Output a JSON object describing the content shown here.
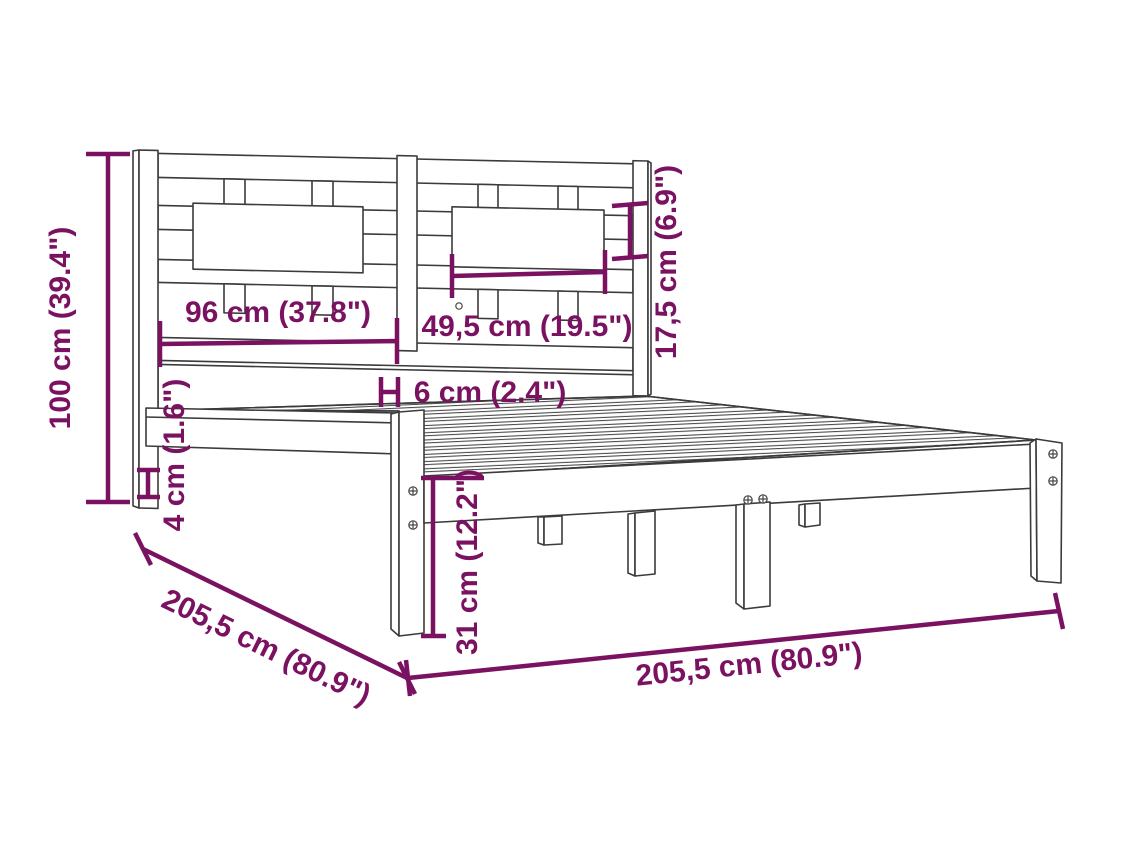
{
  "diagram": {
    "type": "furniture-dimension-diagram",
    "subject": "wooden slatted bed frame with headboard, 3/4 perspective line drawing",
    "accent_color": "#7A1261",
    "outline_color": "#3B3B3B",
    "background_color": "#FFFFFF",
    "dimensions": {
      "total_height": {
        "label": "100 cm (39.4\")",
        "cm": 100,
        "inches": 39.4,
        "measures": "headboard total height"
      },
      "headboard_section_width": {
        "label": "96 cm (37.8\")",
        "cm": 96,
        "inches": 37.8,
        "measures": "left headboard section width"
      },
      "panel_width": {
        "label": "49,5 cm (19.5\")",
        "cm": 49.5,
        "inches": 19.5,
        "measures": "headboard panel width"
      },
      "panel_height": {
        "label": "17,5 cm (6.9\")",
        "cm": 17.5,
        "inches": 6.9,
        "measures": "headboard panel height"
      },
      "slat_width": {
        "label": "6 cm (2.4\")",
        "cm": 6,
        "inches": 2.4,
        "measures": "divider slat width"
      },
      "rail_lip": {
        "label": "4 cm (1.6\")",
        "cm": 4,
        "inches": 1.6,
        "measures": "side rail lip height"
      },
      "base_height": {
        "label": "31 cm (12.2\")",
        "cm": 31,
        "inches": 12.2,
        "measures": "frame height to top of rail"
      },
      "frame_depth": {
        "label": "205,5 cm (80.9\")",
        "cm": 205.5,
        "inches": 80.9,
        "measures": "bed length"
      },
      "frame_width": {
        "label": "205,5 cm (80.9\")",
        "cm": 205.5,
        "inches": 80.9,
        "measures": "bed width"
      }
    }
  }
}
